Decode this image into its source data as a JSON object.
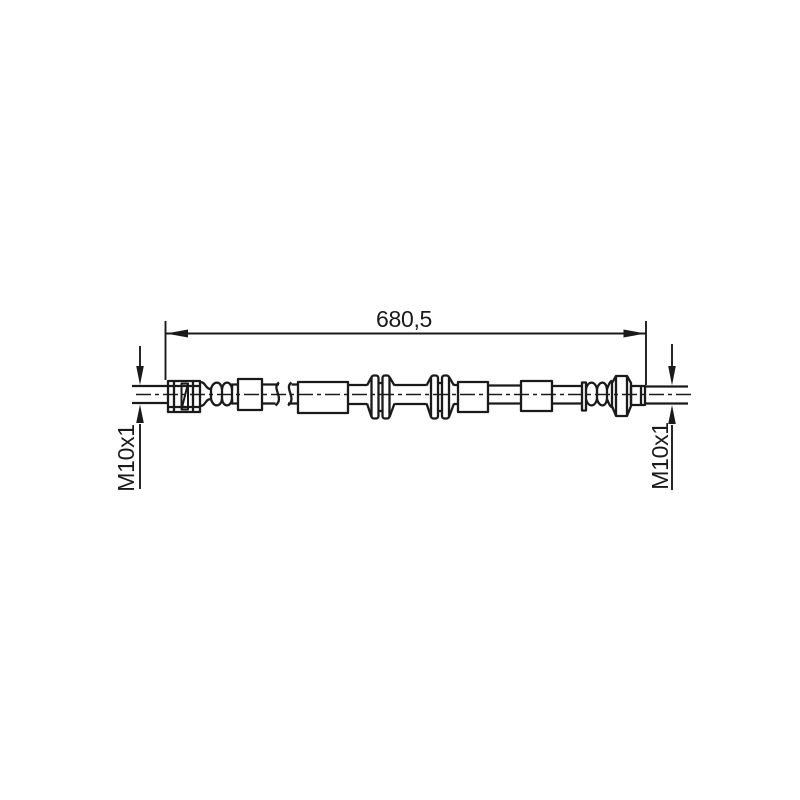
{
  "drawing": {
    "background_color": "#ffffff",
    "line_color": "#1a1a1a",
    "labels": {
      "length": "680,5",
      "thread_left": "M10x1",
      "thread_right": "M10x1"
    }
  }
}
